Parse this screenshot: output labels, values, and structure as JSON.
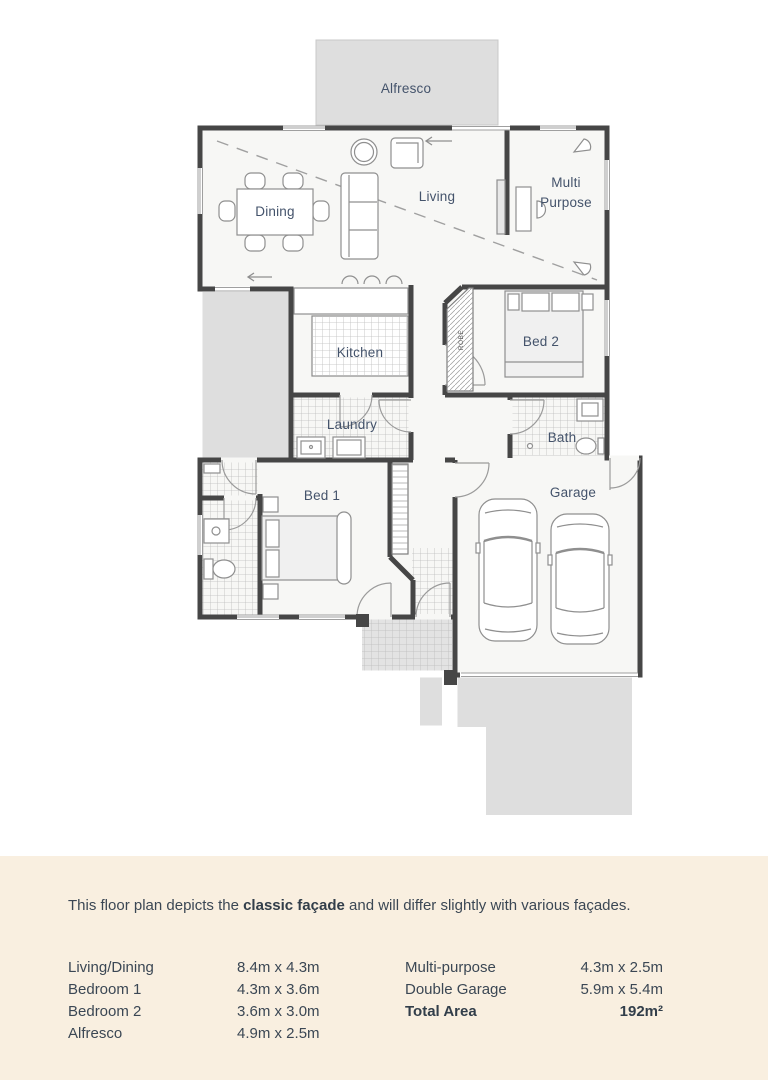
{
  "floorplan": {
    "rooms": {
      "alfresco": "Alfresco",
      "dining": "Dining",
      "living": "Living",
      "multi_purpose": [
        "Multi",
        "Purpose"
      ],
      "kitchen": "Kitchen",
      "bed2": "Bed 2",
      "robe": "ROBE",
      "laundry": "Laundry",
      "bath": "Bath",
      "bed1": "Bed 1",
      "garage": "Garage"
    },
    "colors": {
      "wall": "#464646",
      "outdoor_area": "#dedede",
      "floor": "#f7f7f5",
      "room_label": "#44536b"
    }
  },
  "footer": {
    "background": "#f9efe0",
    "text_color": "#3b4754",
    "disclaimer": {
      "prefix": "This floor plan depicts the ",
      "highlight": "classic façade",
      "suffix": " and will differ slightly with various façades."
    },
    "dimensions": {
      "left": [
        {
          "label": "Living/Dining",
          "value": "8.4m x 4.3m"
        },
        {
          "label": "Bedroom 1",
          "value": "4.3m x 3.6m"
        },
        {
          "label": "Bedroom 2",
          "value": "3.6m x 3.0m"
        },
        {
          "label": "Alfresco",
          "value": "4.9m x 2.5m"
        }
      ],
      "right": [
        {
          "label": "Multi-purpose",
          "value": "4.3m x 2.5m"
        },
        {
          "label": "Double Garage",
          "value": "5.9m x 5.4m"
        },
        {
          "label": "Total Area",
          "value": "192m²"
        }
      ]
    }
  }
}
